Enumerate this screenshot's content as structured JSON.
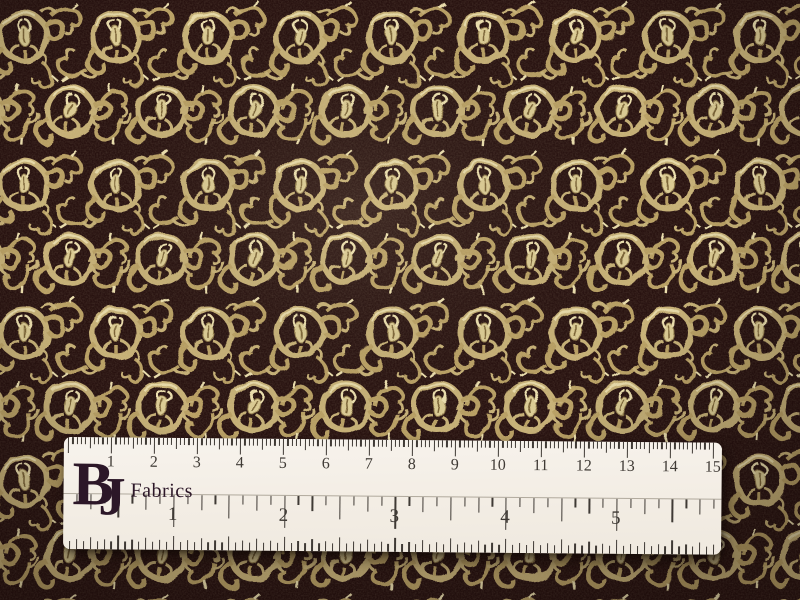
{
  "photo": {
    "subject": "gold-scroll-brocade-fabric-with-ruler"
  },
  "fabric": {
    "name": "metallic-gold-vine-medallion-brocade",
    "colors": {
      "ground": "#22100a",
      "ground_deep": "#180a05",
      "maroon": "#3a1822",
      "gold": "#c6b076",
      "gold_mid": "#b89f63",
      "gold_hi": "#ecdfae",
      "gold_bud": "#dbcb93",
      "gold_deep": "#8d7748"
    }
  },
  "ruler": {
    "brand": {
      "b": "B",
      "j": "J",
      "name": "Fabrics",
      "color": "#2c1728"
    },
    "top_scale": {
      "numbers": [
        "1",
        "2",
        "3",
        "4",
        "5",
        "6",
        "7",
        "8",
        "9",
        "10",
        "11",
        "12",
        "13",
        "14",
        "15"
      ]
    },
    "bottom_scale": {
      "numbers": [
        "1",
        "2",
        "3",
        "4",
        "5"
      ]
    },
    "colors": {
      "body": "#f7f3ed",
      "markings": "#3f3a35"
    }
  }
}
